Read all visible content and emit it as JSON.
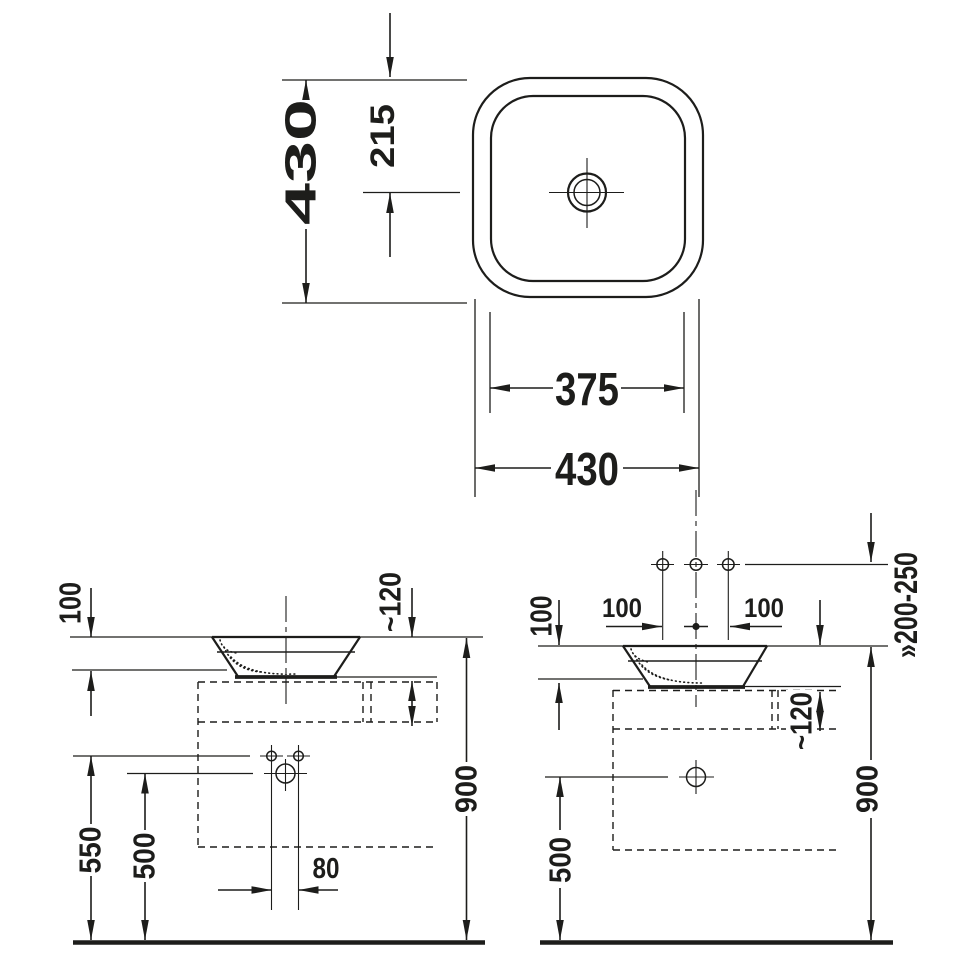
{
  "colors": {
    "line": "#1d1d1b",
    "background": "#ffffff"
  },
  "labels": {
    "top": {
      "overall_height": "430",
      "center_offset": "215",
      "inner_width": "375",
      "overall_width": "430"
    },
    "side": {
      "bowl_height": "100",
      "counter_thickness": "~120",
      "tap_holes_height": "550",
      "drain_height": "500",
      "hole_spacing": "80",
      "rim_height": "900"
    },
    "front": {
      "bowl_height": "100",
      "hole_spacing_left": "100",
      "hole_spacing_right": "100",
      "wall_tap_height": "»200-250",
      "counter_thickness": "~120",
      "drain_height": "500",
      "rim_height": "900"
    }
  }
}
